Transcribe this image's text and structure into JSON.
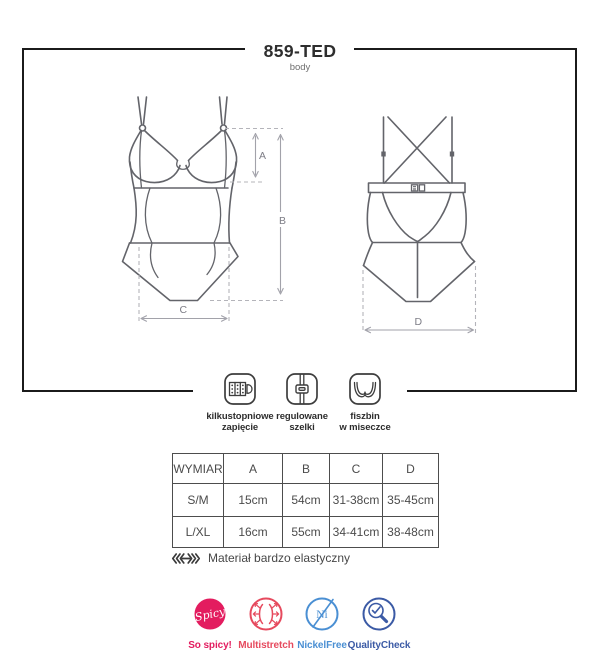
{
  "header": {
    "title": "859-TED",
    "subtitle": "body"
  },
  "diagram": {
    "dim_a": "A",
    "dim_b": "B",
    "dim_c": "C",
    "dim_d": "D",
    "line_color": "#63646a",
    "dash_color": "#b4b4ba"
  },
  "features": [
    {
      "icon": "hook-clasp-icon",
      "label_line1": "kilkustopniowe",
      "label_line2": "zapięcie"
    },
    {
      "icon": "adjustable-strap-icon",
      "label_line1": "regulowane",
      "label_line2": "szelki"
    },
    {
      "icon": "underwire-cup-icon",
      "label_line1": "fiszbin",
      "label_line2": "w miseczce"
    }
  ],
  "size_table": {
    "columns": [
      "WYMIAR",
      "A",
      "B",
      "C",
      "D"
    ],
    "rows": [
      {
        "size": "S/M",
        "values": [
          "15cm",
          "54cm",
          "31-38cm",
          "35-45cm"
        ]
      },
      {
        "size": "L/XL",
        "values": [
          "16cm",
          "55cm",
          "34-41cm",
          "38-48cm"
        ]
      }
    ]
  },
  "material_note": "Materiał bardzo elastyczny",
  "badges": [
    {
      "name": "so-spicy",
      "icon_text": "Spicy",
      "label": "So spicy!",
      "color": "#e31c5f"
    },
    {
      "name": "multistretch",
      "icon_text": "",
      "label": "Multistretch",
      "color": "#e64a5e"
    },
    {
      "name": "nickel-free",
      "icon_text": "Ni",
      "label": "NickelFree",
      "color": "#4a8fd3"
    },
    {
      "name": "quality-check",
      "icon_text": "",
      "label": "QualityCheck",
      "color": "#3b5aa5"
    }
  ]
}
